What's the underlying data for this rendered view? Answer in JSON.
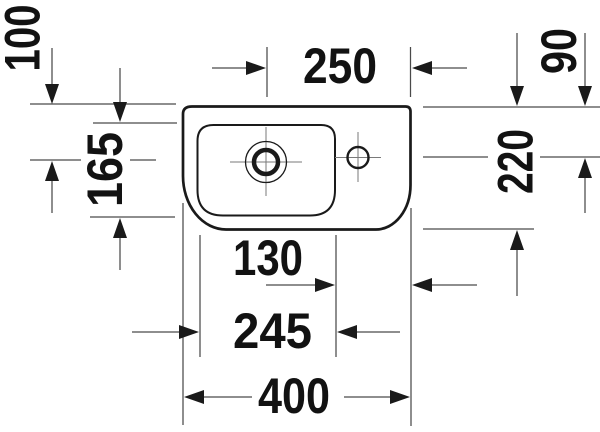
{
  "drawing": {
    "type": "washbasin-top-view-dimension-drawing",
    "colors": {
      "background": "#ffffff",
      "outline": "#1a1a1a",
      "dimension_lines": "#4a4a4a",
      "text": "#121212"
    },
    "dimensions": {
      "drain_from_back": "100",
      "bowl_depth": "165",
      "drain_to_right_edge": "250",
      "faucet_from_back": "90",
      "overall_depth": "220",
      "bowl_to_right_edge": "130",
      "bowl_width": "245",
      "overall_width": "400"
    }
  }
}
